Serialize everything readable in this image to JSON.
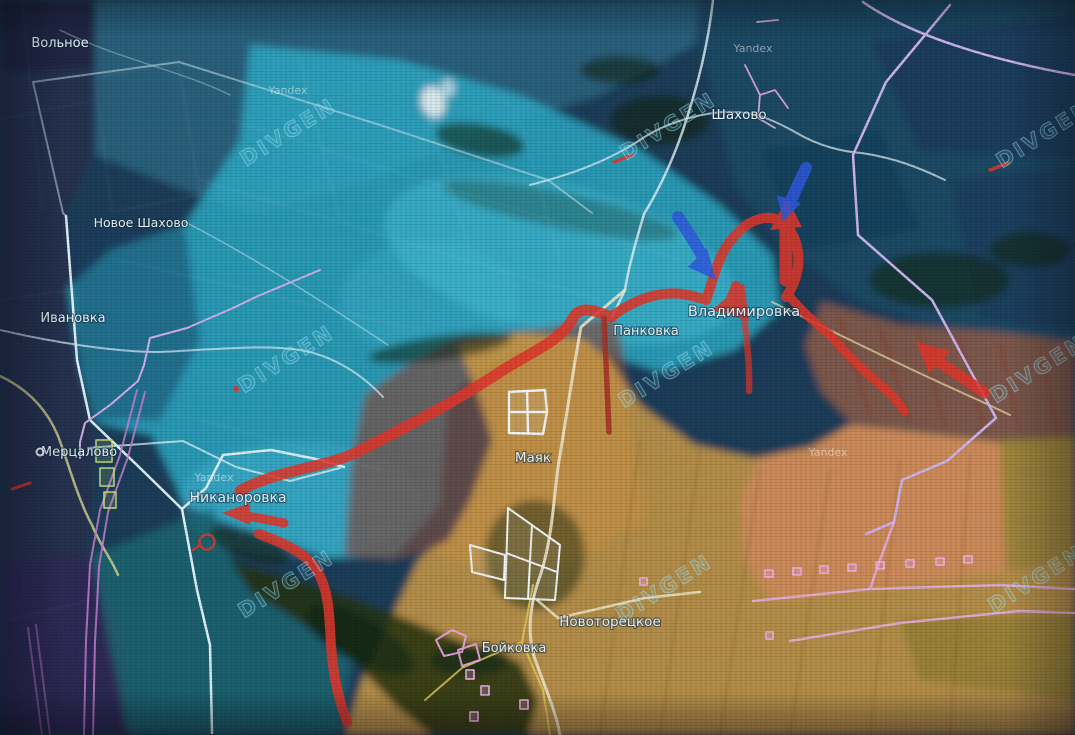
{
  "map": {
    "channel_watermark": "DIVGEN",
    "provider_watermark": "Yandex",
    "settlements": [
      {
        "name": "Вольное"
      },
      {
        "name": "Новое Шахово"
      },
      {
        "name": "Шахово"
      },
      {
        "name": "Ивановка"
      },
      {
        "name": "Мерцалово"
      },
      {
        "name": "Никаноровка"
      },
      {
        "name": "Панковка"
      },
      {
        "name": "Владимировка"
      },
      {
        "name": "Маяк"
      },
      {
        "name": "Новоторецкое"
      },
      {
        "name": "Бойковка"
      }
    ],
    "overlay": {
      "colors": {
        "blue_zone": "#2fadc8",
        "deep_blue_zone": "#28304f",
        "orange_zone": "#d5a045",
        "salmon_zone": "#d58a60",
        "contested_brown": "#7d5146",
        "attack_arrow_red": "#e0372b",
        "arrow_blue": "#3059dd",
        "boundary_pink": "#cdb3ef",
        "railway_magenta": "#c77fd4",
        "road_light": "#e8f4f8",
        "road_cream": "#efe6c8"
      },
      "counts": {
        "divgen_watermarks": 9,
        "yandex_watermarks": 4,
        "red_arrows": 7,
        "blue_arrows": 2
      }
    }
  }
}
